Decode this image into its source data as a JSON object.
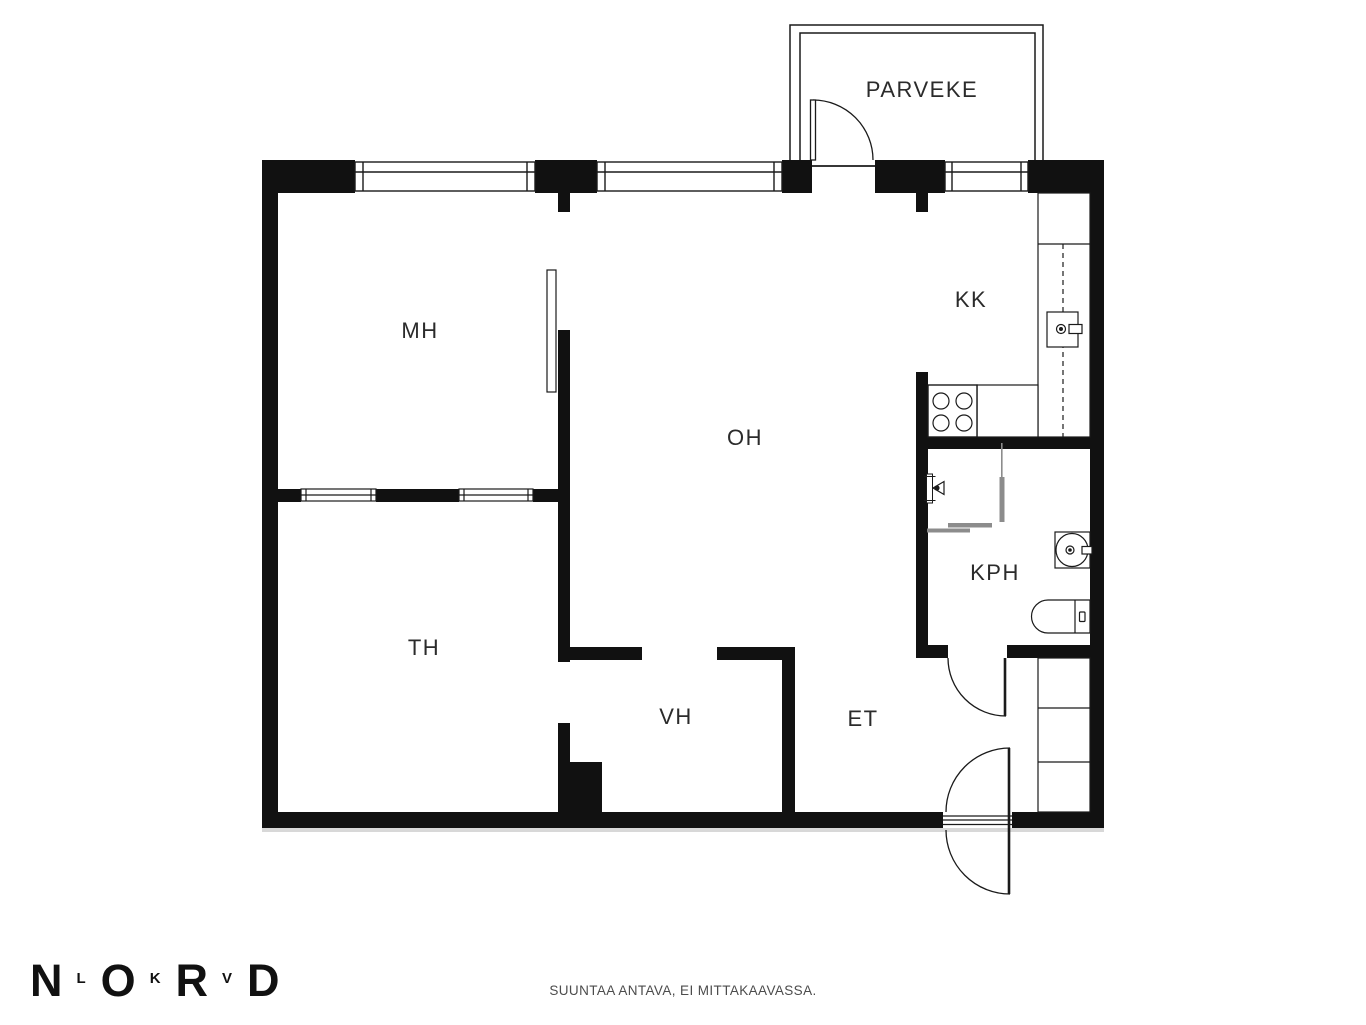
{
  "plan": {
    "type": "apartment-floor-plan",
    "rooms": [
      {
        "id": "parveke",
        "label": "PARVEKE"
      },
      {
        "id": "mh",
        "label": "MH"
      },
      {
        "id": "oh",
        "label": "OH"
      },
      {
        "id": "kk",
        "label": "KK"
      },
      {
        "id": "kph",
        "label": "KPH"
      },
      {
        "id": "th",
        "label": "TH"
      },
      {
        "id": "vh",
        "label": "VH"
      },
      {
        "id": "et",
        "label": "ET"
      }
    ],
    "fixtures": [
      "balcony-door",
      "entrance-double-swing-door",
      "bathroom-door",
      "sliding-door",
      "stove-4-burners",
      "kitchen-sink",
      "kitchen-counter-dashed",
      "shower-head",
      "shower-screens",
      "washbasin",
      "toilet",
      "wardrobe-3-sections",
      "exterior-windows-3",
      "interior-windows-2"
    ],
    "colors": {
      "wall": "#111111",
      "line": "#1a1a1a",
      "screen_gray": "#8c8c8c",
      "shadow": "#d8d8d8",
      "background": "#ffffff"
    }
  },
  "footer": {
    "logo_letters": [
      "N",
      "L",
      "O",
      "K",
      "R",
      "V",
      "D"
    ],
    "disclaimer": "SUUNTAA ANTAVA, EI MITTAKAAVASSA."
  }
}
